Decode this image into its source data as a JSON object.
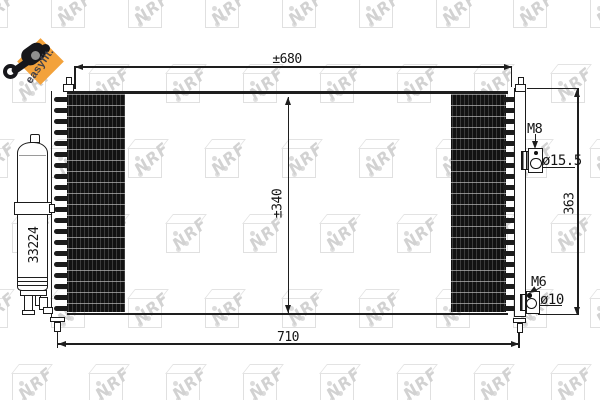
{
  "watermark": {
    "text": "NRF"
  },
  "badge": {
    "label": "easyfit.",
    "icon": "key-tool-icon"
  },
  "drier": {
    "part_number": "33224"
  },
  "dims": {
    "overall_width": "±680",
    "pin_width": "710",
    "core_height": "±340",
    "side_height": "363"
  },
  "fittings": {
    "upper": {
      "thread": "M8",
      "diameter": "ø15.5"
    },
    "lower": {
      "thread": "M6",
      "diameter": "ø10"
    }
  },
  "colors": {
    "badge_orange": "#f3a23b",
    "line_dark": "#1c1c1c",
    "watermark_gray": "#d6d6d6"
  }
}
